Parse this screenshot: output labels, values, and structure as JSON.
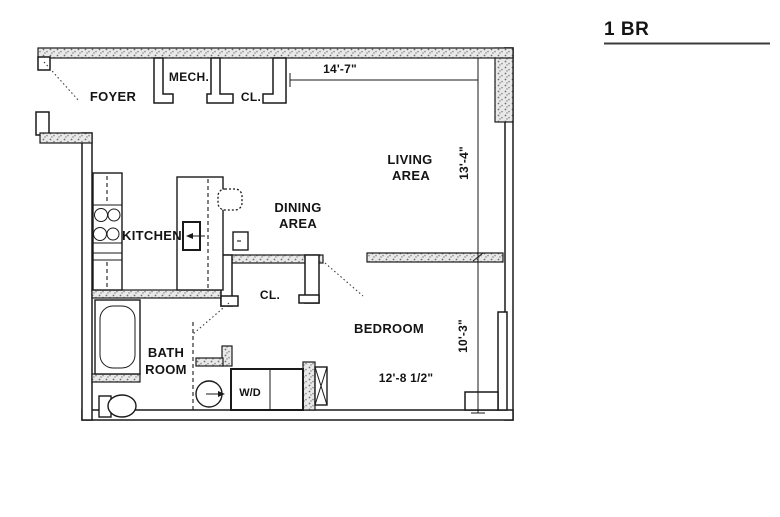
{
  "title": {
    "label": "1 BR"
  },
  "rooms": {
    "foyer": "FOYER",
    "mech": "MECH.",
    "closet_top": "CL.",
    "living1": "LIVING",
    "living2": "AREA",
    "dining1": "DINING",
    "dining2": "AREA",
    "kitchen": "KITCHEN",
    "closet_mid": "CL.",
    "bedroom": "BEDROOM",
    "bath1": "BATH",
    "bath2": "ROOM"
  },
  "dims": {
    "top_width": "14'-7\"",
    "living_height": "13'-4\"",
    "bedroom_height": "10'-3\"",
    "bedroom_width": "12'-8 1/2\""
  },
  "fixtures": {
    "washer_dryer_label": "W/D",
    "icons": [
      "bathtub-icon",
      "toilet-icon",
      "bath-sink-icon",
      "stove-burners-icon",
      "dishwasher-icon",
      "kitchen-sink-icon",
      "washer-dryer-icon",
      "duct-x-icon"
    ]
  },
  "colors": {
    "line": "#1a1a1a",
    "wall_speckle": "#8f8f8f",
    "background": "#ffffff"
  }
}
